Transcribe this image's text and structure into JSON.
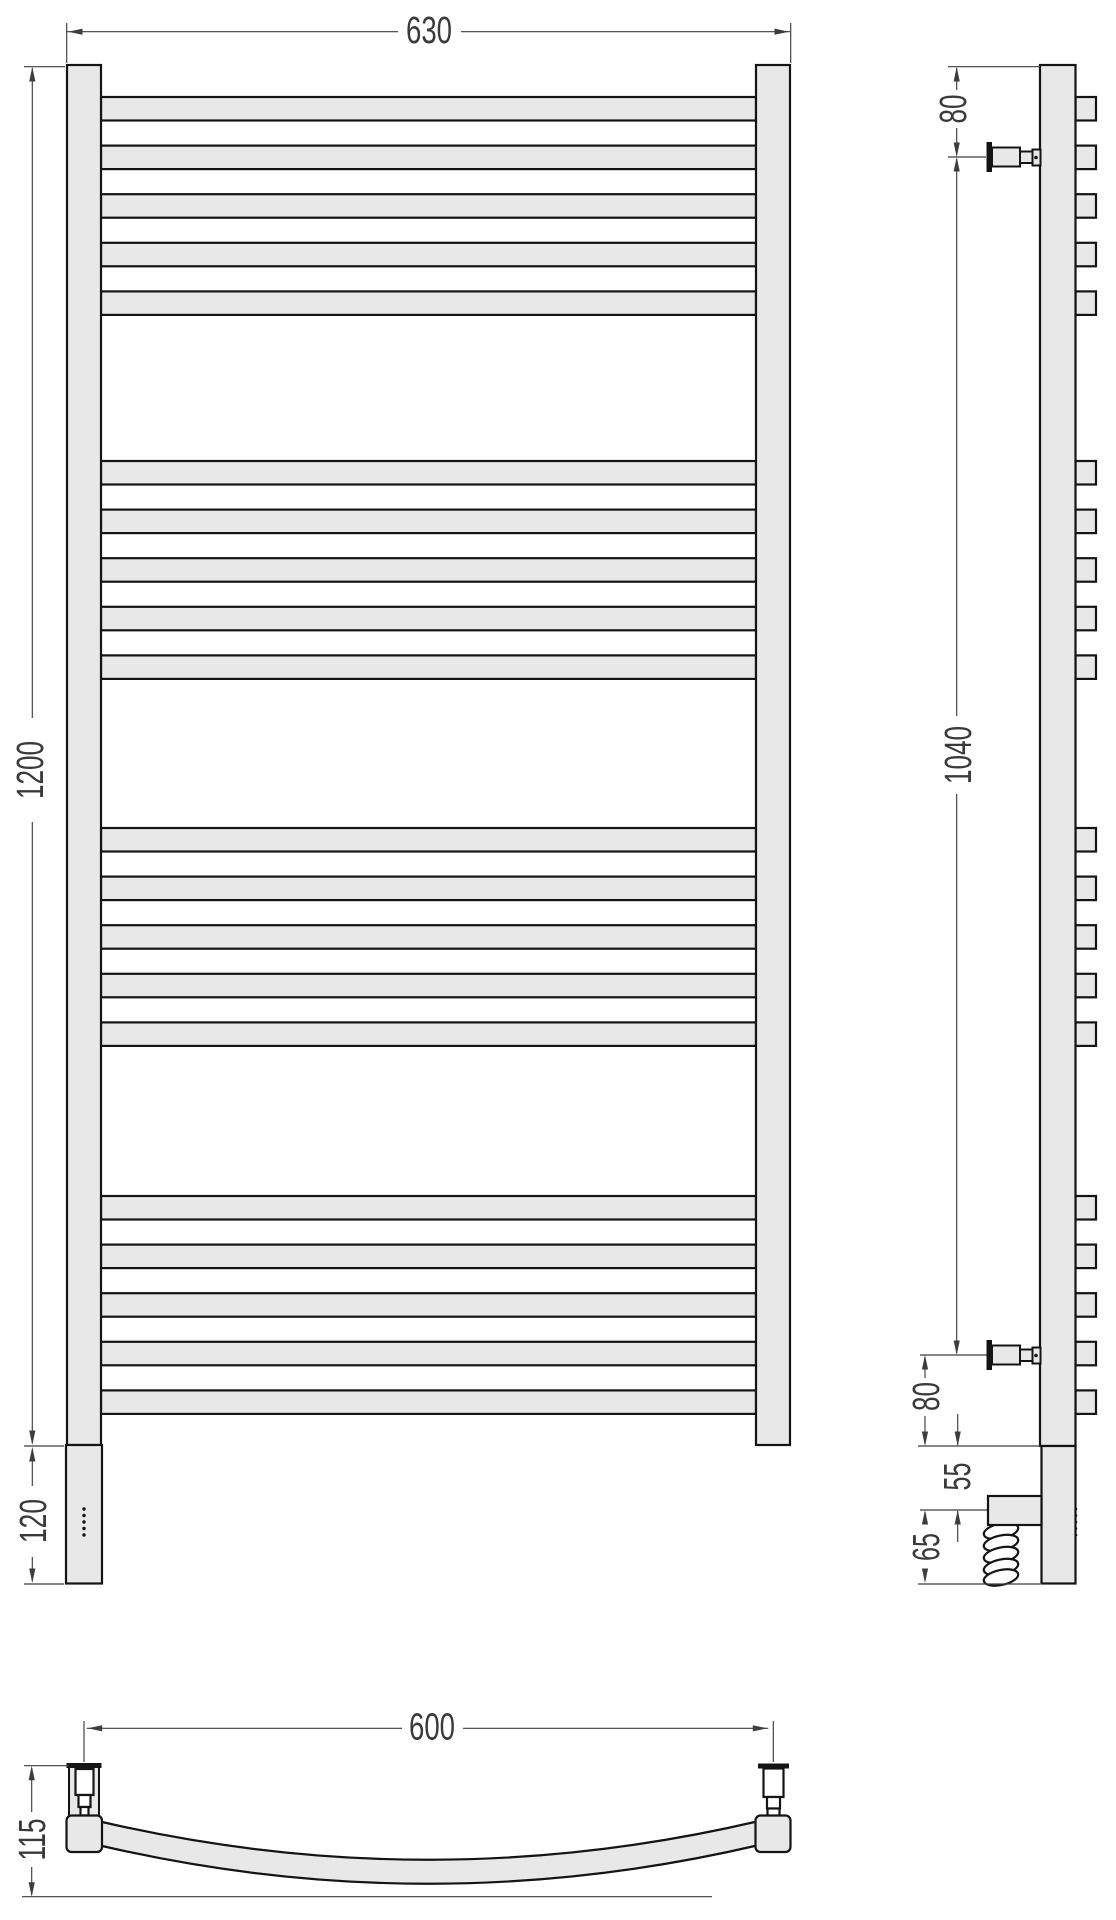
{
  "drawing": {
    "type": "heated towel rail technical drawing, three orthographic views",
    "front_view": {
      "width_label": "630",
      "height_label": "1200",
      "collector_height_label": "120"
    },
    "side_view": {
      "top_offset_label": "80",
      "axis_span_label": "1040",
      "bottom_offset_label": "80",
      "element_top_gap_label": "55",
      "element_bottom_gap_label": "65"
    },
    "plan_view": {
      "span_label": "600",
      "depth_label": "115"
    },
    "colors": {
      "metal_fill": "#e8e8e8",
      "outline": "#141414",
      "dimension": "#3d3d3d"
    }
  },
  "geometry": {
    "bar_group_tops": [
      97,
      461,
      828,
      1196
    ],
    "bars_per_group": 5,
    "bar_pitch": 48.6,
    "bar_height": 23.5,
    "front_bar_x": 101,
    "front_bar_width": 655,
    "side_end_x": 1075.5,
    "side_end_width": 20.5,
    "front_dots": {
      "cx": 84,
      "start_y": 1509,
      "step": 6.5,
      "count": 5,
      "r": 1.7
    },
    "side_dots": {
      "cx": 1076,
      "start_y": 1509,
      "step": 6.5,
      "count": 5,
      "r": 1.3
    },
    "coil_loops": {
      "cx": 1001,
      "rx": 17.5,
      "ry": 7.5,
      "tilt": -12,
      "centers_y": [
        1531,
        1543,
        1555,
        1567,
        1577.5
      ]
    },
    "dim_lines": [
      {
        "name": "dim-630",
        "segs": [
          [
            67,
            31.7,
            398,
            31.7
          ],
          [
            461,
            31.7,
            790,
            31.7
          ]
        ],
        "arrows": [
          [
            68,
            31.7,
            "left"
          ],
          [
            789,
            31.7,
            "right"
          ]
        ],
        "exts": [
          [
            66.7,
            23,
            66.7,
            63
          ],
          [
            790.7,
            23,
            790.7,
            63
          ]
        ]
      },
      {
        "name": "dim-1200",
        "segs": [
          [
            32.3,
            68,
            32.3,
            718
          ],
          [
            32.3,
            822,
            32.3,
            1443
          ]
        ],
        "arrows": [
          [
            32.3,
            67,
            "up"
          ],
          [
            32.3,
            1445,
            "down"
          ]
        ],
        "exts": [
          [
            24,
            66.7,
            65,
            66.7
          ],
          [
            24,
            1446,
            64,
            1446
          ]
        ]
      },
      {
        "name": "dim-120",
        "segs": [
          [
            32.3,
            1449,
            32.3,
            1486
          ],
          [
            32.3,
            1557,
            32.3,
            1581
          ]
        ],
        "arrows": [
          [
            32.3,
            1447,
            "up"
          ],
          [
            32.3,
            1583,
            "down"
          ]
        ],
        "exts": [
          [
            24,
            1584,
            64,
            1584
          ]
        ]
      },
      {
        "name": "dim-80-top",
        "segs": [
          [
            956.7,
            68,
            956.7,
            90
          ],
          [
            956.7,
            128,
            956.7,
            155
          ]
        ],
        "arrows": [
          [
            956.7,
            67,
            "up"
          ],
          [
            956.7,
            157,
            "down"
          ]
        ],
        "exts": [
          [
            948,
            66.7,
            1040,
            66.7
          ],
          [
            948,
            157,
            986,
            157
          ]
        ]
      },
      {
        "name": "dim-1040",
        "segs": [
          [
            956.7,
            159,
            956.7,
            716
          ],
          [
            956.7,
            794,
            956.7,
            1353
          ]
        ],
        "arrows": [
          [
            956.7,
            157,
            "up"
          ],
          [
            956.7,
            1355,
            "down"
          ]
        ],
        "exts": [
          [
            920,
            1355,
            986.5,
            1355
          ]
        ]
      },
      {
        "name": "dim-80-bottom",
        "segs": [
          [
            925,
            1357,
            925,
            1378
          ],
          [
            925,
            1416,
            925,
            1444
          ]
        ],
        "arrows": [
          [
            925,
            1355,
            "up"
          ],
          [
            925,
            1446,
            "down"
          ]
        ],
        "exts": [
          [
            918,
            1446,
            1040,
            1446
          ]
        ]
      },
      {
        "name": "dim-55",
        "segs": [
          [
            957.7,
            1414,
            957.7,
            1445
          ],
          [
            957.7,
            1511,
            957.7,
            1542
          ]
        ],
        "arrows": [
          [
            957.7,
            1446,
            "down"
          ],
          [
            957.7,
            1510,
            "up"
          ]
        ],
        "exts": [
          [
            920,
            1510,
            987,
            1510
          ]
        ]
      },
      {
        "name": "dim-65",
        "segs": [
          [
            925,
            1512,
            925,
            1524
          ],
          [
            925,
            1570,
            925,
            1581
          ]
        ],
        "arrows": [
          [
            925,
            1510,
            "up"
          ],
          [
            925,
            1583,
            "down"
          ]
        ],
        "exts": [
          [
            918,
            1584,
            1040,
            1584
          ]
        ]
      },
      {
        "name": "dim-600",
        "segs": [
          [
            86.7,
            1728.3,
            402,
            1728.3
          ],
          [
            463,
            1728.3,
            768.3,
            1728.3
          ]
        ],
        "arrows": [
          [
            87.7,
            1728.3,
            "left"
          ],
          [
            767.3,
            1728.3,
            "right"
          ]
        ],
        "exts": [
          [
            84,
            1721,
            84,
            1762
          ],
          [
            773.3,
            1721,
            773.3,
            1762
          ]
        ]
      },
      {
        "name": "dim-115",
        "segs": [
          [
            31.7,
            1768,
            31.7,
            1812
          ],
          [
            31.7,
            1867,
            31.7,
            1895
          ]
        ],
        "arrows": [
          [
            31.7,
            1765.7,
            "up"
          ],
          [
            31.7,
            1896.7,
            "down"
          ]
        ],
        "exts": [
          [
            24,
            1765.7,
            69,
            1765.7
          ]
        ]
      }
    ]
  }
}
